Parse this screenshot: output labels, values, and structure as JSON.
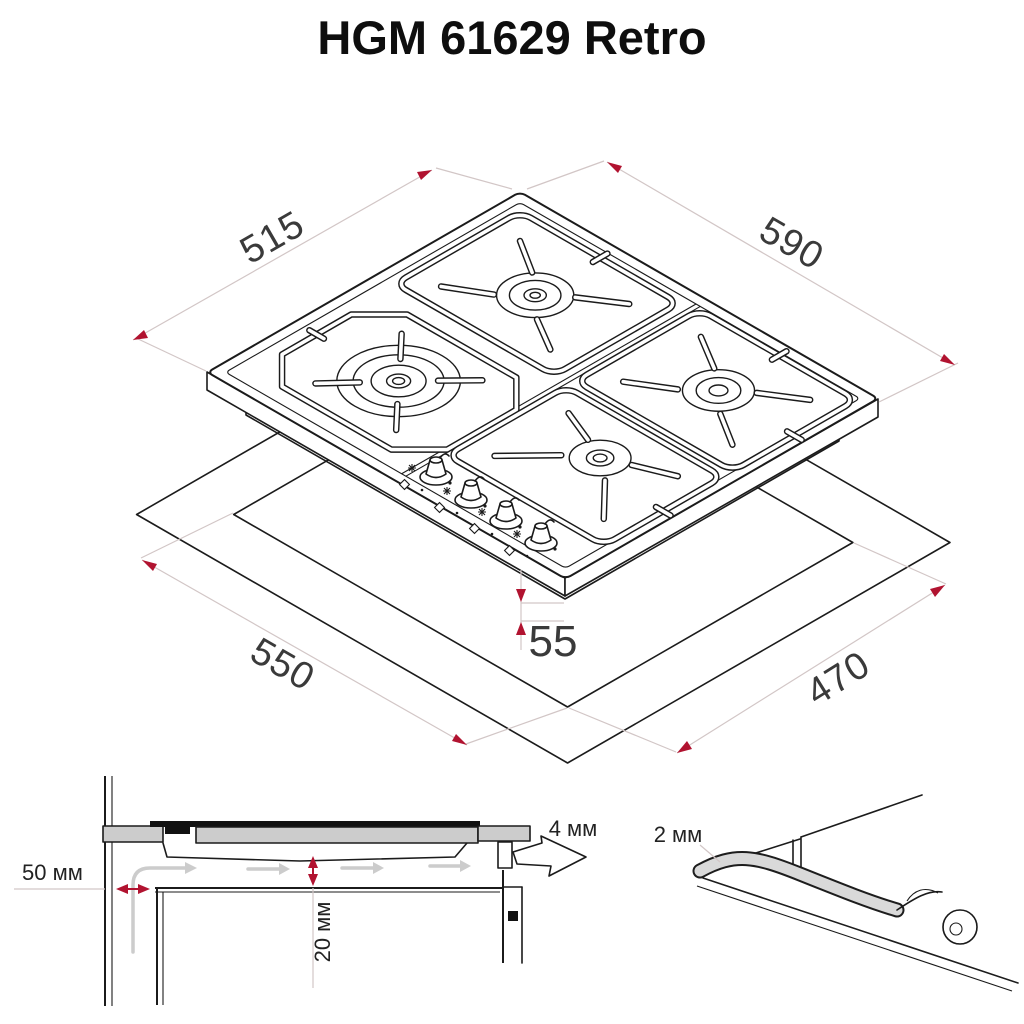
{
  "title": "HGM 61629 Retro",
  "iso": {
    "d515": "515",
    "d590": "590",
    "d550": "550",
    "d470": "470",
    "d55": "55"
  },
  "section": {
    "wall_clearance": "50 мм",
    "bottom_clearance": "20 мм",
    "edge_clearance": "4 мм"
  },
  "detail": {
    "seal_thickness": "2 мм"
  },
  "colors": {
    "accent_red": "#b11330",
    "line_dark": "#1b1b1b",
    "dim_line": "#d2c6c6",
    "section_fill_gray": "#cccccc"
  }
}
